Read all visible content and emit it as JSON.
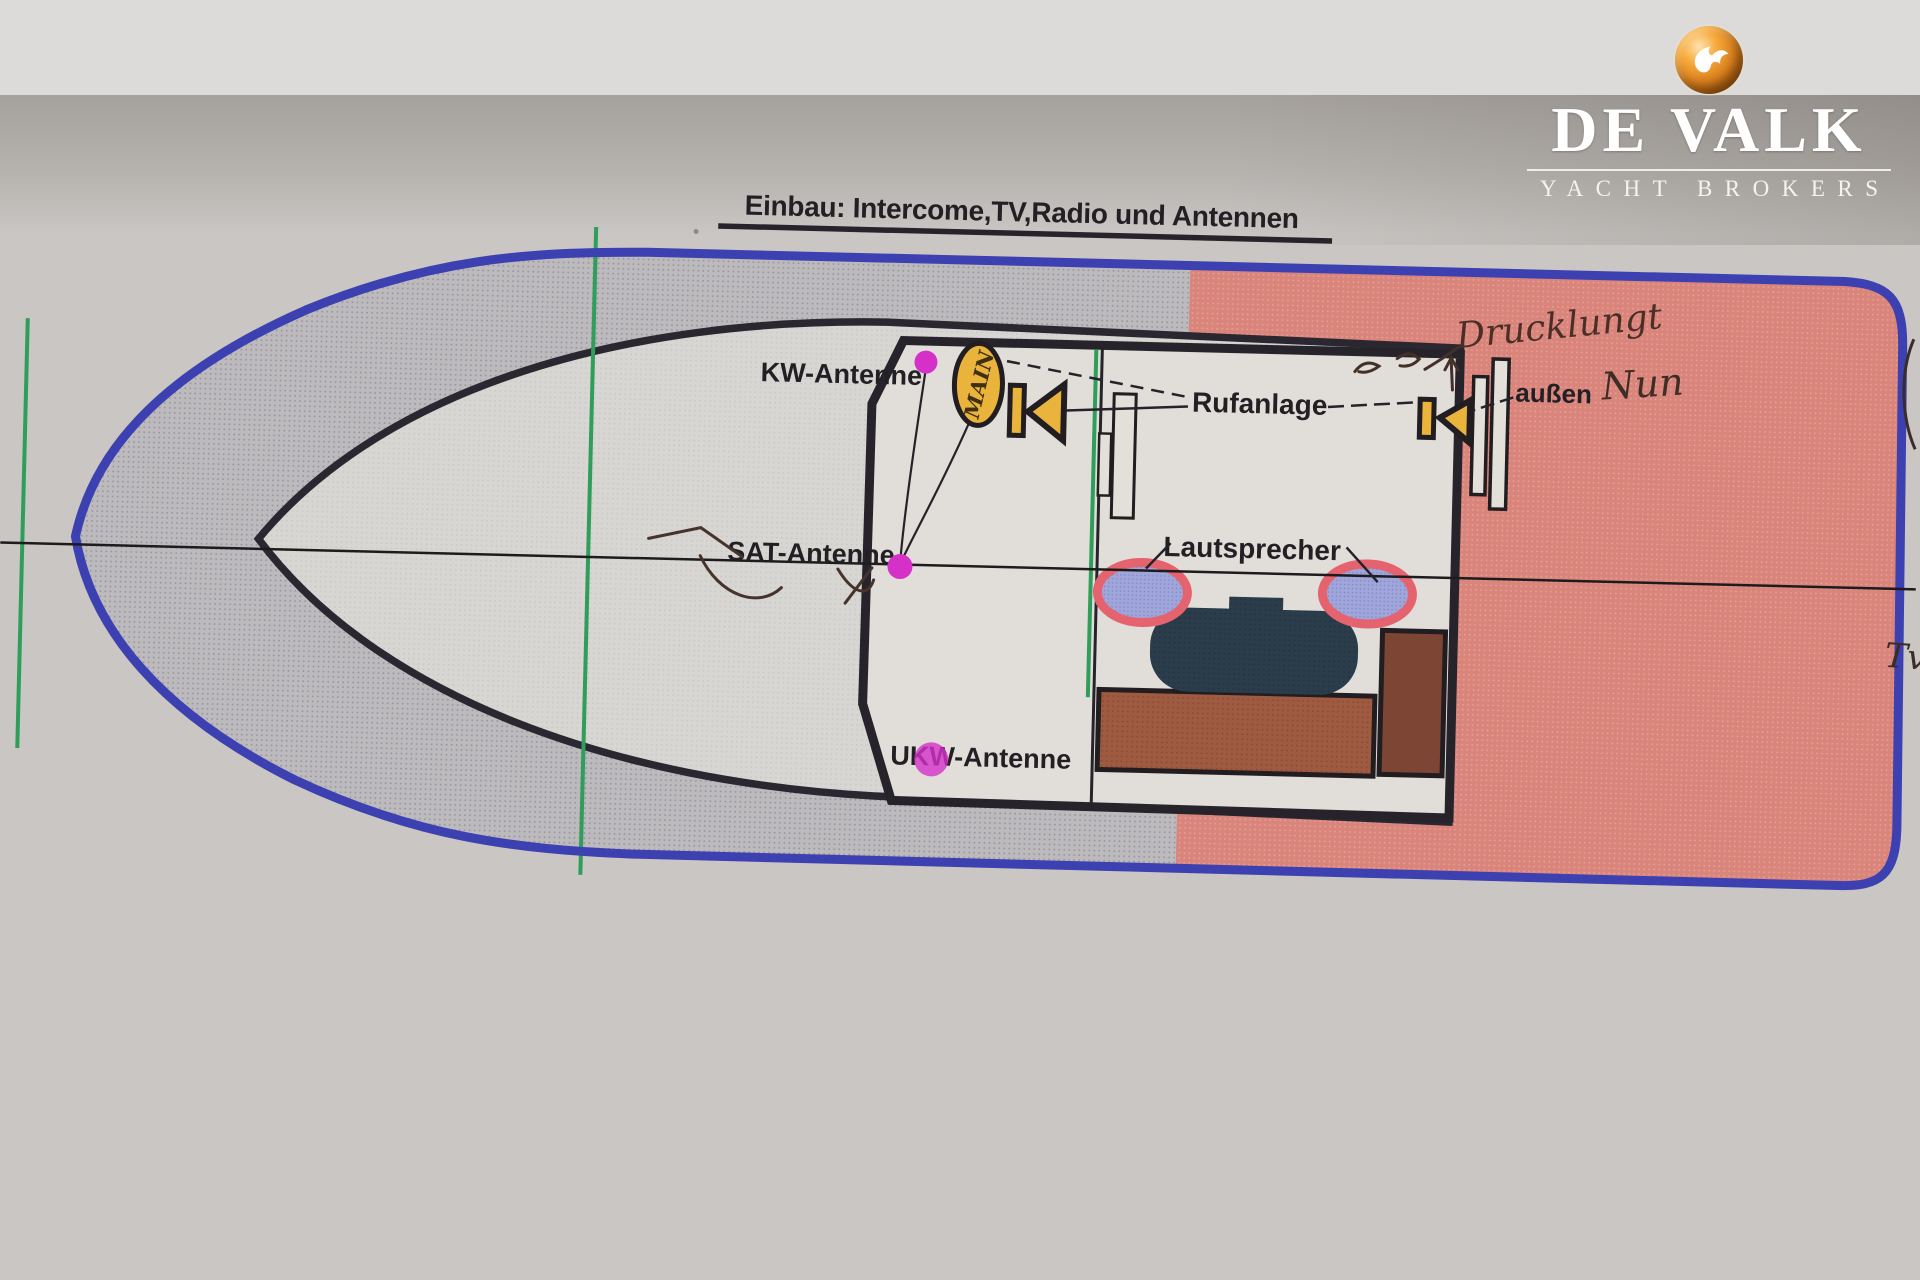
{
  "logo": {
    "brand": "DE VALK",
    "tagline": "YACHT BROKERS",
    "icon": "falcon-sphere"
  },
  "drawing": {
    "title": "Einbau: Intercome,TV,Radio und Antennen",
    "labels": {
      "kw_antenna": "KW-Antenne",
      "sat_antenna": "SAT-Antenne",
      "ukw_antenna": "UKW-Antenne",
      "intercom": "Rufanlage",
      "speakers": "Lautsprecher",
      "outside": "außen"
    },
    "handwritten": {
      "main_unit": "MAIN",
      "note_right": "Drucklungt",
      "outside_note": "Nun",
      "margin_note": "Tv"
    },
    "colors": {
      "hull_outline_blue": "#3c40b0",
      "foredeck_gray": "#bcbabd",
      "aft_deck_salmon": "#d9857c",
      "inner_deck_light": "#d8d6d2",
      "cabin_white": "#e1ded9",
      "speaker_fill_blue": "#a0a6da",
      "speaker_rim_pink": "#e4636f",
      "marker_magenta": "#d531c8",
      "accent_yellow": "#e9b33c",
      "table_navy": "#2b3c4a",
      "bench_brown": "#9e5b41",
      "frame_green": "#2f9e5a",
      "ink_handwriting": "#4b2f27",
      "line_black": "#26232b"
    }
  }
}
